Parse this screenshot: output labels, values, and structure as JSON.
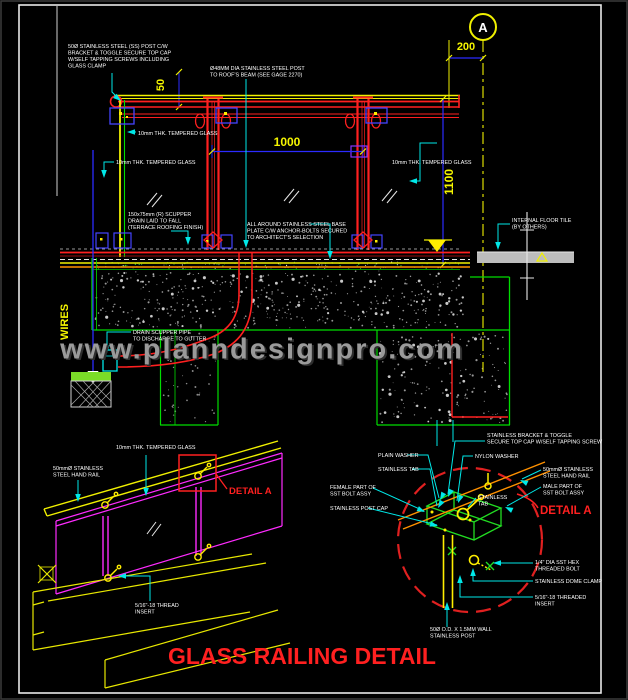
{
  "drawing": {
    "title": "GLASS RAILING DETAIL",
    "watermark": "www.planndesignpro.com",
    "section_marker": "A",
    "wires_label": "WIRES",
    "dims": {
      "d50": "50",
      "d1000": "1000",
      "d1100": "1100",
      "d200": "200"
    },
    "main": {
      "post_note": [
        "50Ø STAINLESS STEEL (SS) POST C/W",
        "BRACKET & TOGGLE SECURE TOP CAP",
        "W/SELF TAPPING SCREWS INCLUDING",
        "GLASS CLAMP"
      ],
      "post_note2": [
        "Ø48MM DIA STAINLESS STEEL POST",
        "TO ROOF'S BEAM (SEE GAGE 2270)"
      ],
      "glass_label": "10mm THK. TEMPERED GLASS",
      "base_note": [
        "ALL AROUND STAINLESS STEEL BASE",
        "PLATE C/W ANCHOR-BOLTS SECURED",
        "TO ARCHITECT'S SELECTION"
      ],
      "scupper_note": [
        "150x75mm (R) SCUPPER",
        "DRAIN LAID TO FALL",
        "(TERRACE ROOFING FINISH)"
      ],
      "drain_note": [
        "DRAIN SCUPPER PIPE",
        "TO DISCHARGE TO GUTTER"
      ],
      "floor_note": [
        "INTERNAL FLOOR TILE",
        "(BY OTHERS)"
      ]
    },
    "iso": {
      "glass_label": "10mm THK. TEMPERED GLASS",
      "handrail_note": [
        "50mmØ STAINLESS",
        "STEEL HAND RAIL"
      ],
      "insert_note": [
        "5/16\"-18 THREAD",
        "INSERT"
      ],
      "detail_ref": "DETAIL A"
    },
    "detail": {
      "title": "DETAIL A",
      "bracket_note": [
        "STAINLESS BRACKET & TOGGLE",
        "SECURE TOP CAP W/SELF TAPPING SCREW"
      ],
      "plain_washer": "PLAIN WASHER",
      "stainless_tab": "STAINLESS TAB",
      "nylon_washer": "NYLON WASHER",
      "handrail_note": [
        "50mmØ STAINLESS",
        "STEEL HAND RAIL"
      ],
      "male_part": [
        "MALE PART OF",
        "SST BOLT ASSY"
      ],
      "female_part": [
        "FEMALE PART OF",
        "SST BOLT ASSY"
      ],
      "post_cap": "STAINLESS POST CAP",
      "tab_note": [
        "STAINLESS",
        "TAB"
      ],
      "hex_bolt": [
        "1/4\" DIA SST HEX",
        "THREADED BOLT"
      ],
      "dome_clamp": "STAINLESS DOME CLAMP",
      "threaded_insert": [
        "5/16\"-18 THREADED",
        "INSERT"
      ],
      "post_spec": [
        "50Ø O.D. X 1.5MM WALL",
        "STAINLESS POST"
      ]
    },
    "colors": {
      "yellow": "#f0f000",
      "red": "#ff2020",
      "green": "#00dd00",
      "cyan": "#00e8e8",
      "blue": "#2b2bff",
      "magenta": "#ff2bff",
      "orange": "#ff9100",
      "watermark_gray": "#9a9a9a",
      "title_red": "#ff2020",
      "background": "#000000"
    }
  }
}
